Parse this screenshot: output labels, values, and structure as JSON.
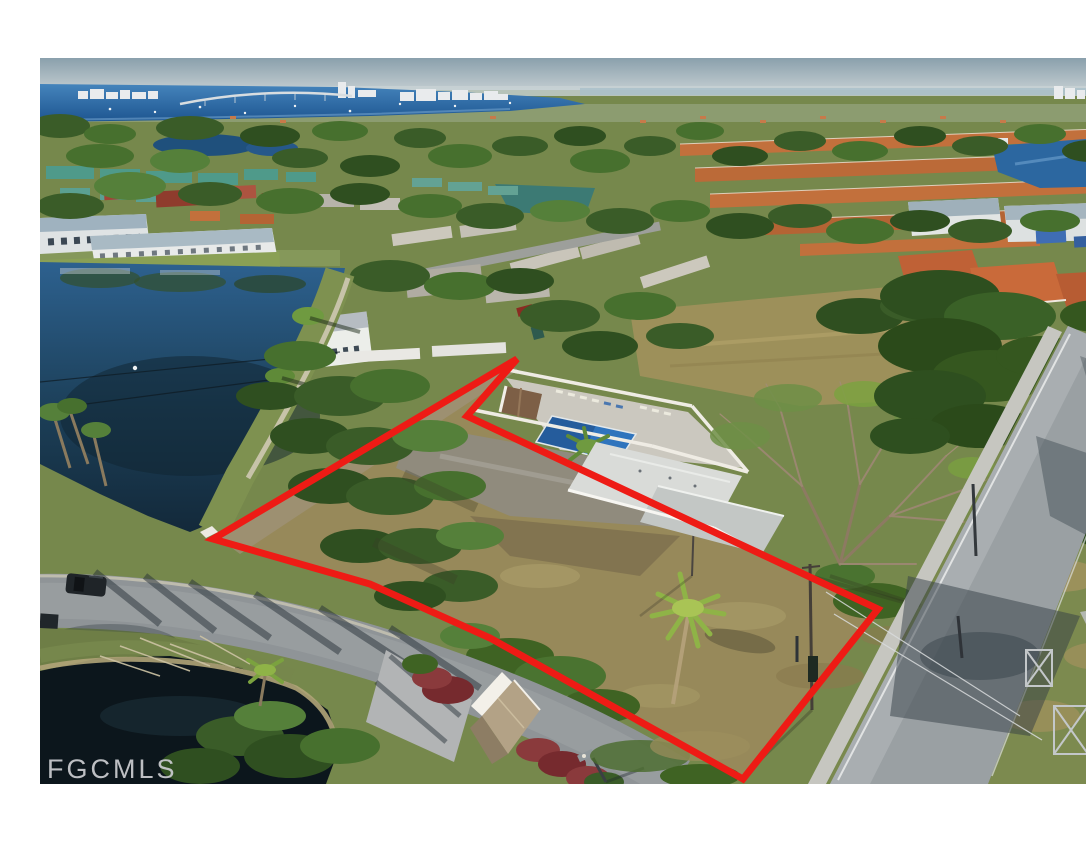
{
  "watermark": {
    "label": "FGCMLS",
    "color": "#c7c9cc"
  },
  "photo": {
    "type": "aerial-drone-photograph",
    "subject": "vacant corner lot outlined in red, lakeside community with pool complex, bay and bridge on horizon",
    "border_color": "#ffffff"
  },
  "property_outline": {
    "color": "#ee1b15",
    "stroke_width": "7",
    "points": "173,523 477,343 427,400 838,593 703,763 450,622 330,568"
  },
  "palette": {
    "sky": "#8aa0ac",
    "bay_water": "#2e6ca8",
    "lake": "#1d4561",
    "dark_pond": "#0c161c",
    "lot_grass": "#97895a",
    "tree_green": "#3a5c28",
    "road_gray": "#9aa0a3",
    "pool_blue": "#2f74bd",
    "roof_orange": "#c2703c",
    "roof_teal": "#4f9a8a",
    "clubhouse_roof": "#d9dbd8"
  }
}
